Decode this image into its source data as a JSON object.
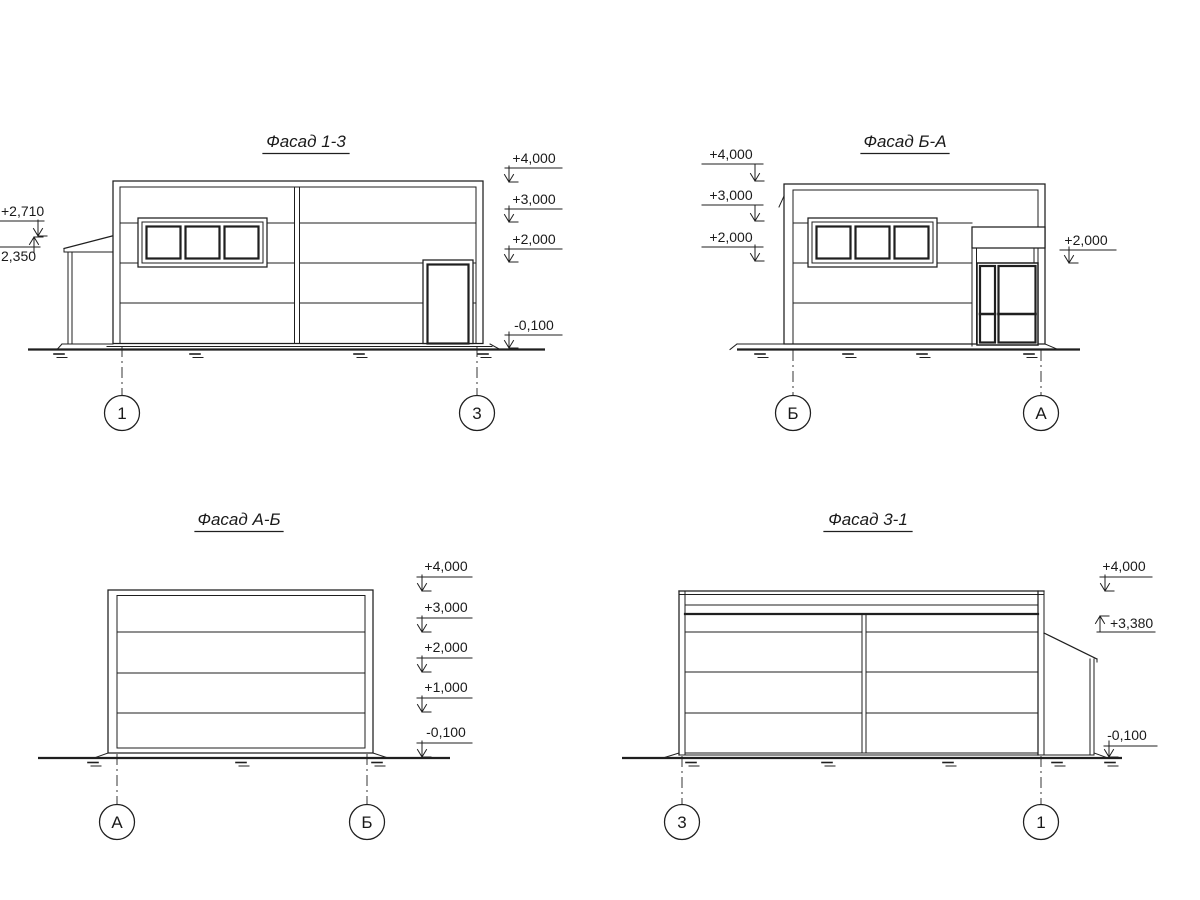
{
  "page": {
    "background": "#ffffff",
    "line_color": "#1f1f1f"
  },
  "facades": {
    "f13": {
      "title": "Фасад 1-3",
      "axes": {
        "left": "1",
        "right": "3"
      },
      "marks": {
        "right": {
          "m1": "+4,000",
          "m2": "+3,000",
          "m3": "+2,000",
          "m4": "-0,100"
        },
        "left": {
          "m1": "+2,710",
          "m2": "2,350"
        }
      }
    },
    "fba": {
      "title": "Фасад Б-А",
      "axes": {
        "left": "Б",
        "right": "А"
      },
      "marks": {
        "left": {
          "m1": "+4,000",
          "m2": "+3,000",
          "m3": "+2,000"
        },
        "right": {
          "m1": "+2,000"
        }
      }
    },
    "fab": {
      "title": "Фасад А-Б",
      "axes": {
        "left": "А",
        "right": "Б"
      },
      "marks": {
        "right": {
          "m1": "+4,000",
          "m2": "+3,000",
          "m3": "+2,000",
          "m4": "+1,000",
          "m5": "-0,100"
        }
      }
    },
    "f31": {
      "title": "Фасад 3-1",
      "axes": {
        "left": "3",
        "right": "1"
      },
      "marks": {
        "right": {
          "m1": "+4,000",
          "m2": "+3,380",
          "m3": "-0,100"
        }
      }
    }
  }
}
